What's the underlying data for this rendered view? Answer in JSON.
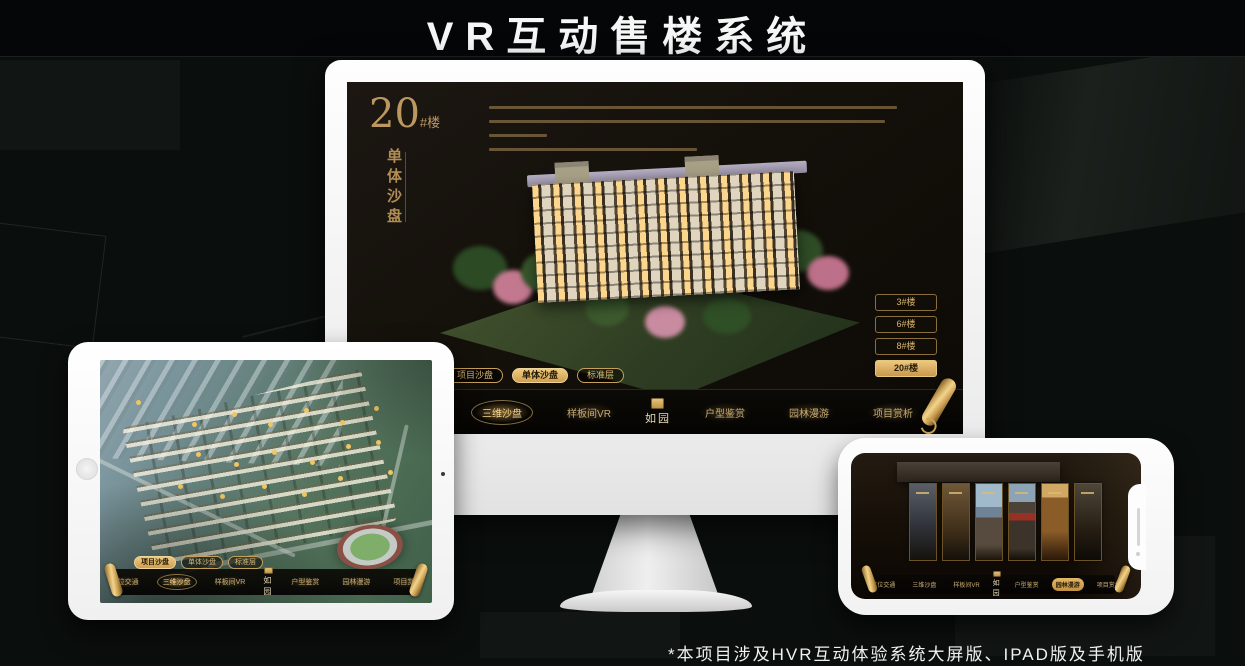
{
  "page": {
    "title": "VR互动售楼系统",
    "footnote": "*本项目涉及HVR互动体验系统大屏版、IPAD版及手机版"
  },
  "colors": {
    "gold": "#c9a05f",
    "gold_bright": "#eecb82",
    "screen_bg": "#14100a",
    "canvas_bg": "#0a0e0c"
  },
  "icons": {
    "scroll": "gold rolled-scroll handle",
    "seal": "gold brand seal above logo text",
    "home": "tablet home button circle",
    "notch": "phone notch with speaker slot"
  },
  "monitor": {
    "heading_number": "20",
    "heading_suffix": "#楼",
    "heading_sub": "单体沙盘",
    "building_buttons": [
      {
        "label": "3#楼"
      },
      {
        "label": "6#楼"
      },
      {
        "label": "8#楼"
      },
      {
        "label": "20#楼"
      }
    ],
    "active_building": "20#楼",
    "tabs": [
      {
        "label": "项目沙盘"
      },
      {
        "label": "单体沙盘"
      },
      {
        "label": "标准层"
      }
    ],
    "active_tab": "单体沙盘",
    "nav": [
      {
        "label": "区位交通"
      },
      {
        "label": "三维沙盘"
      },
      {
        "label": "样板间VR"
      },
      {
        "label": "户型鉴赏"
      },
      {
        "label": "园林漫游"
      },
      {
        "label": "项目赏析"
      }
    ],
    "active_nav": "三维沙盘",
    "logo": "如园"
  },
  "tablet": {
    "tabs": [
      {
        "label": "项目沙盘"
      },
      {
        "label": "单体沙盘"
      },
      {
        "label": "标准层"
      }
    ],
    "active_tab": "项目沙盘",
    "nav": [
      {
        "label": "区位交通"
      },
      {
        "label": "三维沙盘"
      },
      {
        "label": "样板间VR"
      },
      {
        "label": "户型鉴赏"
      },
      {
        "label": "园林漫游"
      },
      {
        "label": "项目赏析"
      }
    ],
    "active_nav": "三维沙盘",
    "logo": "如园"
  },
  "phone": {
    "nav": [
      {
        "label": "区位交通"
      },
      {
        "label": "三维沙盘"
      },
      {
        "label": "样板间VR"
      },
      {
        "label": "户型鉴赏"
      },
      {
        "label": "园林漫游"
      },
      {
        "label": "项目赏析"
      }
    ],
    "active_nav": "园林漫游",
    "logo": "如园"
  }
}
